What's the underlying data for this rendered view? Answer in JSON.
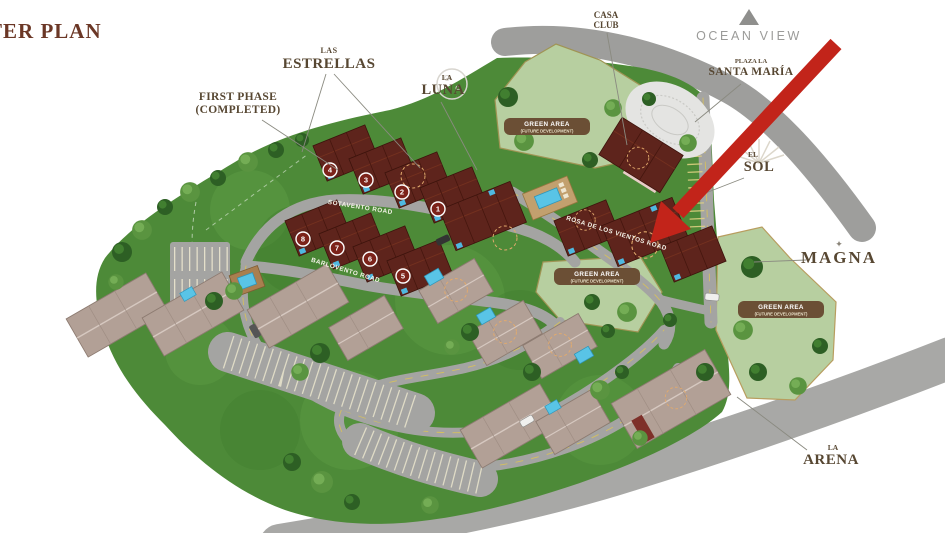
{
  "page": {
    "title": "MASTER PLAN"
  },
  "annotations": {
    "first_phase_line1": "FIRST PHASE",
    "first_phase_line2": "(COMPLETED)"
  },
  "areas": {
    "las_estrellas": {
      "pre": "LAS",
      "name": "ESTRELLAS"
    },
    "la_luna": {
      "pre": "LA",
      "name": "LUNA"
    },
    "casa_club": {
      "pre": "CASA",
      "name": "CLUB"
    },
    "ocean_view": {
      "name": "OCEAN VIEW"
    },
    "plaza_santa_maria": {
      "pre": "PLAZA LA",
      "name": "SANTA MARÍA"
    },
    "el_sol": {
      "pre": "EL",
      "name": "SOL"
    },
    "magna": {
      "name": "MAGNA"
    },
    "la_arena": {
      "pre": "LA",
      "name": "ARENA"
    }
  },
  "green_area_badge": {
    "line1": "GREEN AREA",
    "line2": "(FUTURE DEVELOPMENT)"
  },
  "roads": {
    "sotavento": "SOTAVENTO ROAD",
    "barlovento": "BARLOVENTO ROAD",
    "rosa": "ROSA DE LOS VIENTOS ROAD"
  },
  "building_numbers": [
    "1",
    "2",
    "3",
    "4",
    "5",
    "6",
    "7",
    "8"
  ],
  "icons": {
    "magna_star": "✦"
  },
  "colors": {
    "title_brown": "#6b3726",
    "label_brown": "#574732",
    "arrow_red": "#c2241a",
    "site_green": "#4d8a38",
    "future_green": "#b7cfa0",
    "road_gray": "#a4a4a2",
    "roof_maroon": "#5e241c",
    "roof_tan": "#b2a096",
    "badge_brown": "#6b4f35",
    "pool_blue": "#59c4e6",
    "ocean_view_gray": "#9b9b99"
  }
}
